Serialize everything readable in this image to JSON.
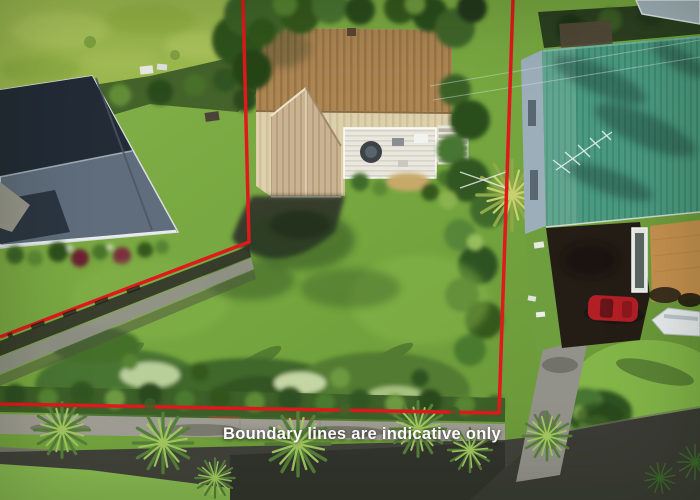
{
  "meta": {
    "type": "aerial-property-photo",
    "width": 700,
    "height": 500
  },
  "caption": {
    "text": "Boundary lines are indicative only",
    "color": "#ffffff"
  },
  "boundary": {
    "color": "#e0191c",
    "stroke_width": 3.5,
    "left_line_points": [
      [
        243,
        0
      ],
      [
        249,
        242
      ],
      [
        0,
        337
      ]
    ],
    "right_line_points": [
      [
        513,
        0
      ],
      [
        499,
        413
      ],
      [
        0,
        404
      ]
    ]
  },
  "scene": {
    "lawn_color": "#76a83f",
    "field_color": "#9dba50",
    "left_house_roof_dark": "#222b36",
    "left_house_roof_light": "#5f6d7c",
    "center_house_roof_top": "#ad8655",
    "center_house_roof_body": "#e2d6b2",
    "center_house_gable": "#c9b392",
    "right_house_roof": "#4b9a80",
    "right_house_wall": "#9daebb",
    "red_car_color": "#b21f25",
    "boat_color": "#eaeef0",
    "road_color": "#41423b",
    "driveway_color": "#92918a",
    "footpath_color": "#a09e94",
    "patio_color": "#c7914f",
    "hedge_color": "#3d5f28"
  }
}
